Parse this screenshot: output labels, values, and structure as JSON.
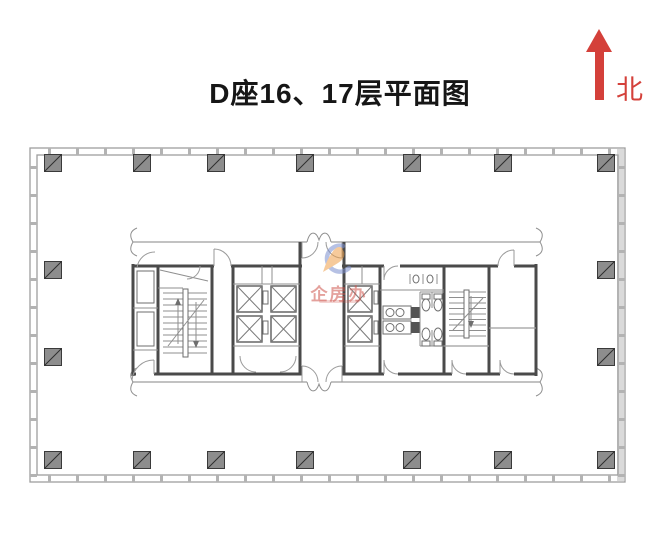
{
  "header": {
    "title": "D座16、17层平面图"
  },
  "compass": {
    "label": "北",
    "color": "#d4403a"
  },
  "watermark": {
    "brand": "企房办",
    "text_color": "rgba(206,84,74,0.55)",
    "logo_orange": "#efa04b",
    "logo_blue": "#7c90cf"
  },
  "plan": {
    "kind": "floor-plan",
    "colors": {
      "wall_light": "#9e9e9e",
      "wall_dark": "#4a4a4a",
      "column_fill": "#8d8d8d",
      "column_stroke": "#3a3a3a",
      "curtain_tick": "#b3b3b3",
      "glass_fill": "#dadada"
    }
  }
}
